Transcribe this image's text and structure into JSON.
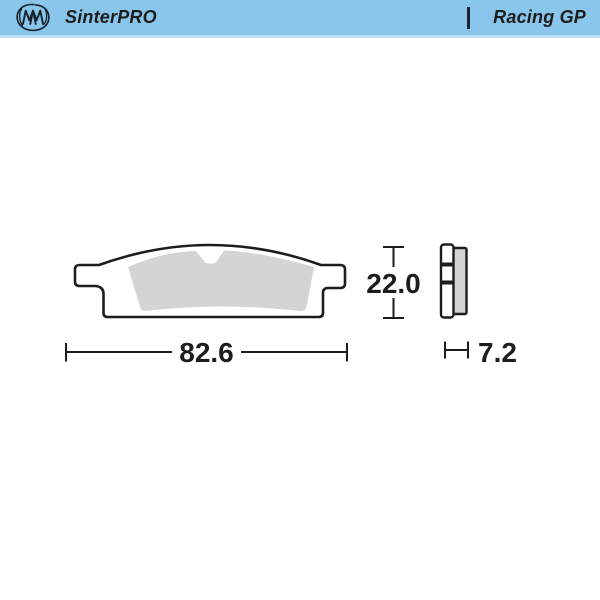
{
  "header": {
    "brand": "SinterPRO",
    "series": "Racing GP",
    "logo_icon": "moto-master-swirl-logo",
    "background_color": "#8ac5ec",
    "text_color": "#1d1d1b"
  },
  "drawing": {
    "subject": "brake-pad-technical-drawing",
    "views": {
      "front": "pad front profile with left and right mounting tabs and center notch",
      "side": "pad edge profile with backing plate and friction strip"
    },
    "dimensions": {
      "width": "82.6",
      "height": "22.0",
      "thickness": "7.2"
    },
    "colors": {
      "line": "#1d1d1b",
      "friction_material": "#d4d4d4",
      "backing_plate": "#ffffff"
    }
  }
}
